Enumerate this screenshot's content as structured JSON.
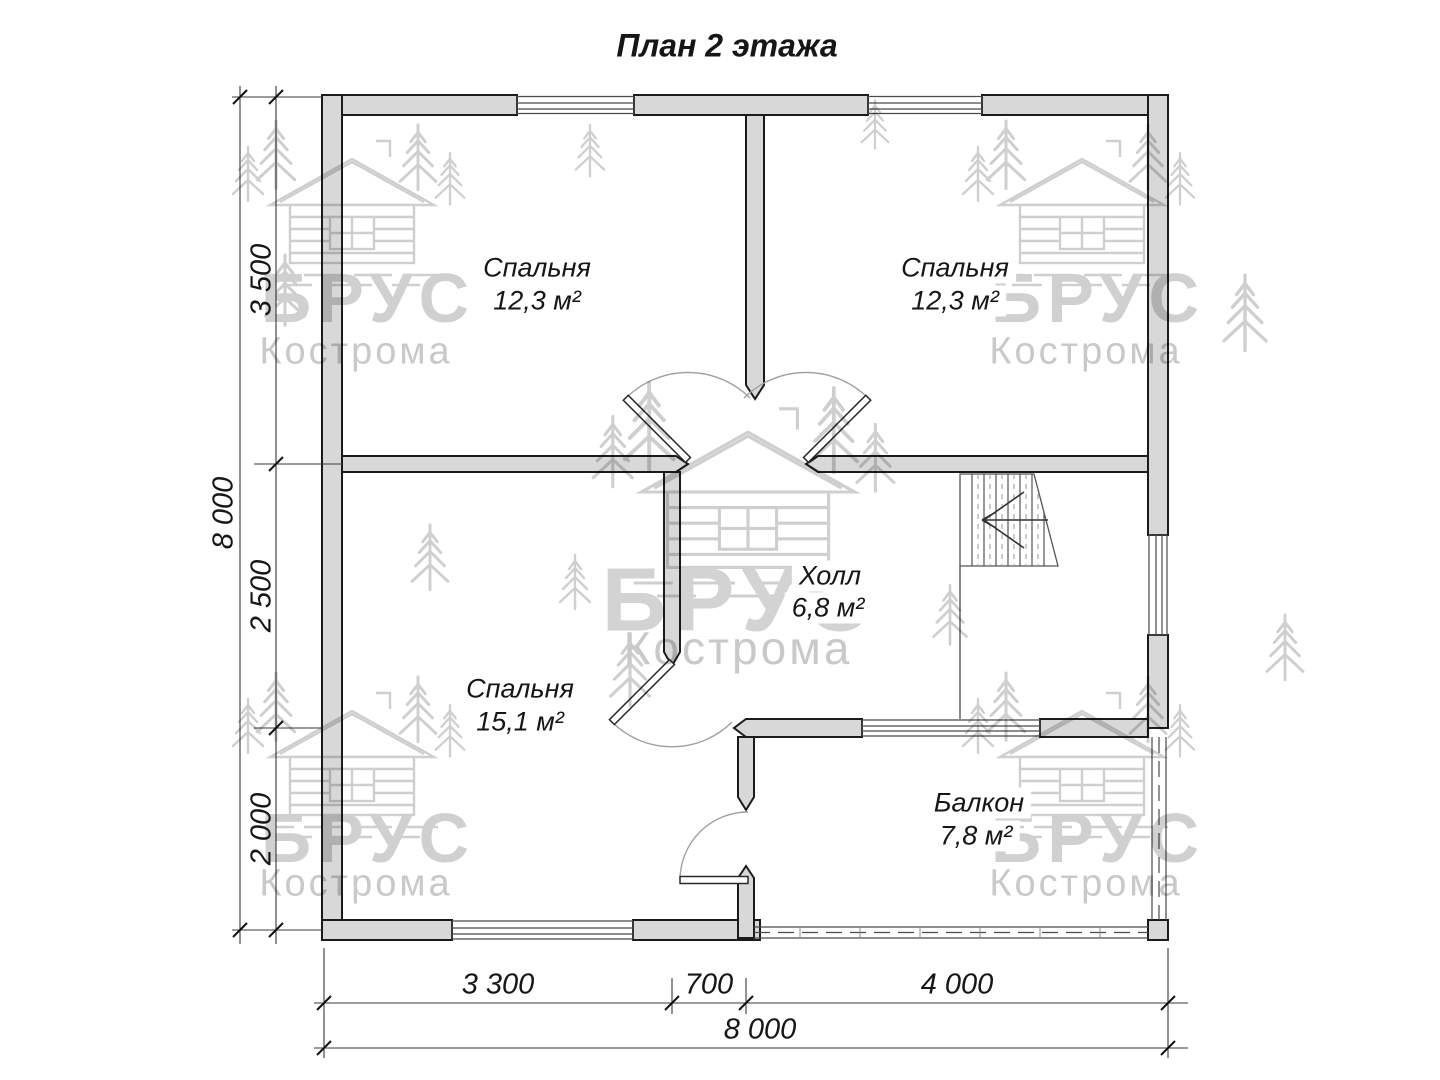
{
  "title": "План 2 этажа",
  "watermark": {
    "brand": "БРУС",
    "city": "Кострома"
  },
  "rooms": {
    "bedroom_top_left": {
      "name": "Спальня",
      "area": "12,3 м²"
    },
    "bedroom_top_right": {
      "name": "Спальня",
      "area": "12,3 м²"
    },
    "bedroom_bottom_left": {
      "name": "Спальня",
      "area": "15,1 м²"
    },
    "hall": {
      "name": "Холл",
      "area": "6,8 м²"
    },
    "balcony": {
      "name": "Балкон",
      "area": "7,8 м²"
    }
  },
  "dimensions": {
    "left": {
      "segments": [
        "3 500",
        "2 500",
        "2 000"
      ],
      "total": "8 000"
    },
    "bottom": {
      "segments": [
        "3 300",
        "700",
        "4 000"
      ],
      "total": "8 000"
    }
  },
  "colors": {
    "wall_fill": "#d8d8d8",
    "wall_line": "#1b1b1b",
    "watermark": "#cfcfcf"
  }
}
